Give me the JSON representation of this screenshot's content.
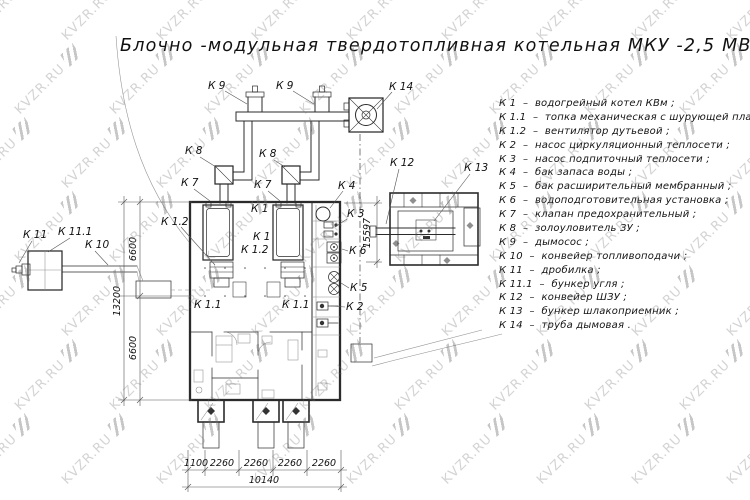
{
  "title": "Блочно -модульная твердотопливная котельная МКУ -2,5  МВт",
  "watermark": {
    "text": "KVZR.RU"
  },
  "legend": {
    "items": [
      {
        "label": "К 1  –  водогрейный котел КВм ;"
      },
      {
        "label": "К 1.1  –  топка механическая с шурующей планкой ;"
      },
      {
        "label": "К 1.2  –  вентилятор дутьевой ;"
      },
      {
        "label": "К 2  –  насос циркуляционный теплосети ;"
      },
      {
        "label": "К 3  –  насос подпиточный теплосети ;"
      },
      {
        "label": "К 4  –  бак запаса воды ;"
      },
      {
        "label": "К 5  –  бак расширительный мембранный ;"
      },
      {
        "label": "К 6  –  водоподготовительная установка ;"
      },
      {
        "label": "К 7  –  клапан предохранительный ;"
      },
      {
        "label": "К 8  –  золоуловитель ЗУ ;"
      },
      {
        "label": "К 9  –  дымосос ;"
      },
      {
        "label": "К 10  –  конвейер топливоподачи ;"
      },
      {
        "label": "К 11  –  дробилка ;"
      },
      {
        "label": "К 11.1  –  бункер угля ;"
      },
      {
        "label": "К 12  –  конвейер ШЗУ ;"
      },
      {
        "label": "К 13  –  бункер шлакоприемник ;"
      },
      {
        "label": "К 14  –  труба дымовая ."
      }
    ]
  },
  "drawing": {
    "labels": {
      "k9_a": "К 9",
      "k9_b": "К 9",
      "k14": "К 14",
      "k8_a": "К 8",
      "k8_b": "К 8",
      "k7_a": "К 7",
      "k7_b": "К 7",
      "k4": "К 4",
      "k3": "К 3",
      "k6": "К 6",
      "k5": "К 5",
      "k2": "К 2",
      "k1_a": "К 1",
      "k1_b": "К 1",
      "k1_2_a": "К 1.2",
      "k1_2_b": "К 1.2",
      "k1_1_a": "К 1.1",
      "k1_1_b": "К 1.1",
      "k11": "К 11",
      "k11_1": "К 11.1",
      "k10": "К 10",
      "k12": "К 12",
      "k13": "К 13"
    },
    "dimensions": {
      "left_upper": "6600",
      "left_total": "13200",
      "left_lower": "6600",
      "right_height": "15597",
      "bottom": [
        "1100",
        "2260",
        "2260",
        "2260",
        "2260"
      ],
      "bottom_total": "10140"
    }
  },
  "colors": {
    "background": "#ffffff",
    "line": "#2b2b2b",
    "watermark_gray": "#6e6e6e"
  }
}
